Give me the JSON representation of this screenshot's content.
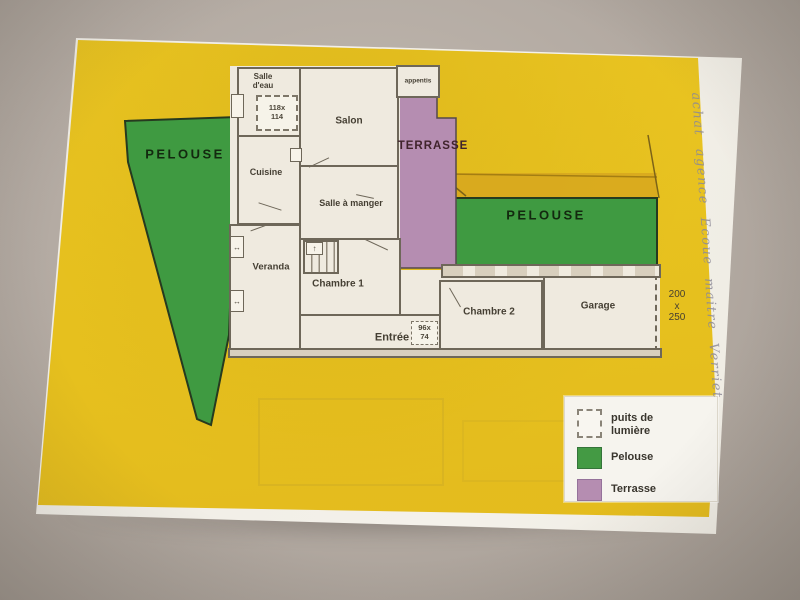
{
  "scene": {
    "description": "photo of a paper house floor plan on a gray table",
    "colors": {
      "background": "#b3aaa2",
      "paper_white": "#f2efe8",
      "highlight_yellow": "#e6c01e",
      "band_mustard": "#d7a71e",
      "pelouse_green": "#3f9a41",
      "terrasse_purple": "#b58db1",
      "plan_fill": "#efeadf",
      "wall_line": "#6e6759"
    }
  },
  "zones": {
    "pelouse_left": {
      "label": "PELOUSE"
    },
    "pelouse_right": {
      "label": "PELOUSE"
    },
    "terrasse": {
      "label": "TERRASSE"
    }
  },
  "rooms": {
    "salle_deau": {
      "label": "Salle\nd'eau"
    },
    "salon": {
      "label": "Salon"
    },
    "appentis": {
      "label": "appentis"
    },
    "cuisine": {
      "label": "Cuisine"
    },
    "salle_a_manger": {
      "label": "Salle à manger"
    },
    "veranda": {
      "label": "Veranda"
    },
    "chambre1": {
      "label": "Chambre 1"
    },
    "entree": {
      "label": "Entrée"
    },
    "chambre2": {
      "label": "Chambre 2"
    },
    "garage": {
      "label": "Garage"
    },
    "stairs_arrow": "↑",
    "window_arrow": "↔"
  },
  "annotations": {
    "puits_dimensions": "118x\n114",
    "entree_dimensions": "96x\n74",
    "garage_dimensions": "200\nx\n250",
    "handwritten_note": "achat agence Ecoue maitre Verriet"
  },
  "legend": {
    "items": [
      {
        "key": "puits",
        "label": "puits de\nlumière"
      },
      {
        "key": "pelouse",
        "label": "Pelouse"
      },
      {
        "key": "terrasse",
        "label": "Terrasse"
      }
    ]
  }
}
